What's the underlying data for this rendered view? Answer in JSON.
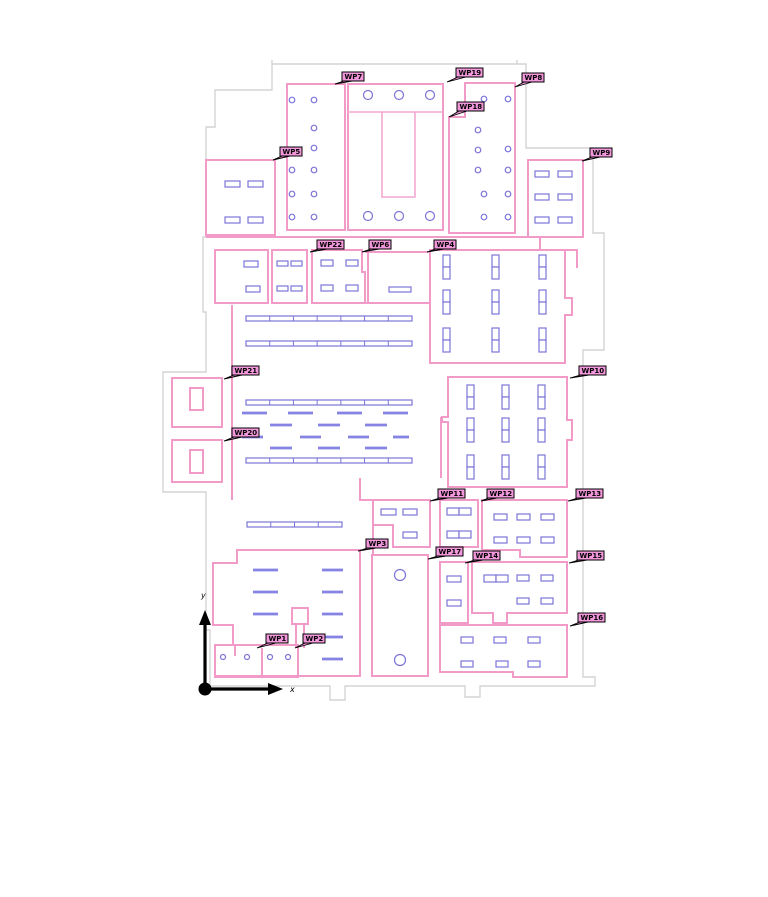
{
  "colors": {
    "background": "#ffffff",
    "wall": "#F29BC9",
    "wall_inner": "#F4A8D1",
    "outline": "#D4D4D4",
    "furniture": "#7B74D8",
    "furniture_fill": "#FFFFFF",
    "dash": "#8583E3",
    "label_fill": "#F297DC",
    "label_border": "#000000",
    "label_text": "#000000",
    "axis": "#000000"
  },
  "axis": {
    "x_label": "x",
    "y_label": "y",
    "origin": [
      205,
      689
    ],
    "x_tip": [
      283,
      689
    ],
    "y_tip": [
      205,
      610
    ],
    "x_label_pos": [
      290,
      692
    ],
    "y_label_pos": [
      201,
      598
    ]
  },
  "waypoints": [
    {
      "id": "WP1",
      "box": [
        266,
        634,
        22,
        9
      ],
      "anchor": [
        257,
        648
      ]
    },
    {
      "id": "WP2",
      "box": [
        303,
        634,
        22,
        9
      ],
      "anchor": [
        295,
        648
      ]
    },
    {
      "id": "WP3",
      "box": [
        366,
        539,
        22,
        9
      ],
      "anchor": [
        358,
        551
      ]
    },
    {
      "id": "WP4",
      "box": [
        434,
        240,
        22,
        9
      ],
      "anchor": [
        427,
        252
      ]
    },
    {
      "id": "WP5",
      "box": [
        280,
        147,
        22,
        9
      ],
      "anchor": [
        273,
        160
      ]
    },
    {
      "id": "WP6",
      "box": [
        369,
        240,
        22,
        9
      ],
      "anchor": [
        362,
        252
      ]
    },
    {
      "id": "WP7",
      "box": [
        342,
        72,
        22,
        9
      ],
      "anchor": [
        335,
        84
      ]
    },
    {
      "id": "WP8",
      "box": [
        522,
        73,
        22,
        9
      ],
      "anchor": [
        515,
        87
      ]
    },
    {
      "id": "WP9",
      "box": [
        590,
        148,
        22,
        9
      ],
      "anchor": [
        582,
        161
      ]
    },
    {
      "id": "WP10",
      "box": [
        579,
        366,
        27,
        9
      ],
      "anchor": [
        570,
        378
      ]
    },
    {
      "id": "WP11",
      "box": [
        438,
        489,
        27,
        9
      ],
      "anchor": [
        430,
        501
      ]
    },
    {
      "id": "WP12",
      "box": [
        487,
        489,
        27,
        9
      ],
      "anchor": [
        481,
        501
      ]
    },
    {
      "id": "WP13",
      "box": [
        576,
        489,
        27,
        9
      ],
      "anchor": [
        568,
        501
      ]
    },
    {
      "id": "WP14",
      "box": [
        473,
        551,
        27,
        9
      ],
      "anchor": [
        465,
        563
      ]
    },
    {
      "id": "WP15",
      "box": [
        577,
        551,
        27,
        9
      ],
      "anchor": [
        569,
        563
      ]
    },
    {
      "id": "WP16",
      "box": [
        578,
        613,
        27,
        9
      ],
      "anchor": [
        570,
        626
      ]
    },
    {
      "id": "WP17",
      "box": [
        436,
        547,
        27,
        9
      ],
      "anchor": [
        428,
        559
      ]
    },
    {
      "id": "WP18",
      "box": [
        457,
        102,
        27,
        9
      ],
      "anchor": [
        449,
        117
      ]
    },
    {
      "id": "WP19",
      "box": [
        456,
        68,
        27,
        9
      ],
      "anchor": [
        447,
        82
      ]
    },
    {
      "id": "WP20",
      "box": [
        232,
        428,
        27,
        9
      ],
      "anchor": [
        224,
        441
      ]
    },
    {
      "id": "WP21",
      "box": [
        232,
        366,
        27,
        9
      ],
      "anchor": [
        224,
        379
      ]
    },
    {
      "id": "WP22",
      "box": [
        317,
        240,
        27,
        9
      ],
      "anchor": [
        310,
        252
      ]
    }
  ],
  "floorplan": {
    "outline_path": "M272,60 V64 H517 V60 M517,64 H526 V148 H593 V233 H604 V350 H583 V677 H595 V686 H480 V697 H465 V686 H345 V700 H330 V686 H210 V630 H206 V492 H163 V372 H206 V312 H203 V237 H206 V127 H215 V90 H272 V64",
    "walls": [
      "M206,160 H275 V235 H206 Z",
      "M287,84 H345 V230 H287 Z",
      "M348,84 H443 V230 H348 Z",
      "M465,83 H515 V233 H449 V117 H465 Z",
      "M528,160 H583 V237 H528 Z",
      "M540,237 V250 H577 V268",
      "M206,237 H528",
      "M215,250 H268 V303 H215 Z",
      "M272,250 H307 V303 H272 Z",
      "M312,250 H362 V272 H365 V303 H312 Z",
      "M365,252 H428 M368,252 V303 M365,303 H430",
      "M430,250 H565 V298 H572 V315 H565 V363 H430 Z",
      "M448,377 H567 V420 H572 V440 H567 V487 H448 V422 H442 V417 H448 Z",
      "M172,378 H222 V427 H172 Z",
      "M190,388 h13 v22 h-13 Z",
      "M172,440 H222 V482 H172 Z",
      "M190,450 h13 v23 h-13 Z",
      "M232,305 V500",
      "M360,478 V500 H373 V555",
      "M441,417 V478",
      "M237,550 H360 V676 H215 V645 H233 V625 H213 V563 H237 Z",
      "M215,645 H298 V677 H215 Z",
      "M235,645 V656",
      "M262,648 V677",
      "M292,608 h16 v16 h-16 Z",
      "M296,624 V648 M304,624 V648",
      "M372,555 H428 V676 H372 Z",
      "M373,500 H430 V547 H393 V525 H373 Z",
      "M440,500 H478 V547 H440 Z",
      "M482,500 H567 V557 H520 V550 H482 Z",
      "M440,562 H468 V623 H440 Z",
      "M472,562 H567 V613 H507 V623 H493 V613 H472 Z",
      "M440,625 H567 V677 H513 V672 H440 Z"
    ],
    "inner_walls": [
      "M348,112 H443",
      "M382,112 V197 H415 V112"
    ],
    "desks": [
      [
        225,
        181,
        15,
        6
      ],
      [
        248,
        181,
        15,
        6
      ],
      [
        225,
        217,
        15,
        6
      ],
      [
        248,
        217,
        15,
        6
      ],
      [
        535,
        171,
        14,
        6
      ],
      [
        558,
        171,
        14,
        6
      ],
      [
        535,
        194,
        14,
        6
      ],
      [
        558,
        194,
        14,
        6
      ],
      [
        535,
        217,
        14,
        6
      ],
      [
        558,
        217,
        14,
        6
      ],
      [
        244,
        261,
        14,
        6
      ],
      [
        246,
        286,
        14,
        6
      ],
      [
        277,
        261,
        11,
        5
      ],
      [
        291,
        261,
        11,
        5
      ],
      [
        277,
        286,
        11,
        5
      ],
      [
        291,
        286,
        11,
        5
      ],
      [
        321,
        260,
        12,
        6
      ],
      [
        346,
        260,
        12,
        6
      ],
      [
        321,
        285,
        12,
        6
      ],
      [
        346,
        285,
        12,
        6
      ],
      [
        389,
        287,
        22,
        5
      ],
      [
        381,
        509,
        15,
        6
      ],
      [
        403,
        509,
        14,
        6
      ],
      [
        403,
        532,
        14,
        6
      ],
      [
        447,
        508,
        12,
        7
      ],
      [
        459,
        508,
        12,
        7
      ],
      [
        447,
        531,
        12,
        7
      ],
      [
        459,
        531,
        12,
        7
      ],
      [
        494,
        514,
        13,
        6
      ],
      [
        517,
        514,
        13,
        6
      ],
      [
        541,
        514,
        13,
        6
      ],
      [
        494,
        537,
        13,
        6
      ],
      [
        517,
        537,
        13,
        6
      ],
      [
        541,
        537,
        13,
        6
      ],
      [
        447,
        576,
        14,
        6
      ],
      [
        447,
        600,
        14,
        6
      ],
      [
        484,
        575,
        12,
        7
      ],
      [
        496,
        575,
        12,
        7
      ],
      [
        517,
        575,
        12,
        6
      ],
      [
        541,
        575,
        12,
        6
      ],
      [
        517,
        598,
        12,
        6
      ],
      [
        541,
        598,
        12,
        6
      ],
      [
        461,
        637,
        12,
        6
      ],
      [
        494,
        637,
        12,
        6
      ],
      [
        528,
        637,
        12,
        6
      ],
      [
        461,
        661,
        12,
        6
      ],
      [
        496,
        661,
        12,
        6
      ],
      [
        528,
        661,
        12,
        6
      ]
    ],
    "vdesks": [
      [
        443,
        255
      ],
      [
        492,
        255
      ],
      [
        539,
        255
      ],
      [
        443,
        290
      ],
      [
        492,
        290
      ],
      [
        539,
        290
      ],
      [
        443,
        328
      ],
      [
        492,
        328
      ],
      [
        539,
        328
      ],
      [
        467,
        385
      ],
      [
        502,
        385
      ],
      [
        538,
        385
      ],
      [
        467,
        418
      ],
      [
        502,
        418
      ],
      [
        538,
        418
      ],
      [
        467,
        455
      ],
      [
        502,
        455
      ],
      [
        538,
        455
      ]
    ],
    "shelves": [
      {
        "x": 246,
        "y": 316,
        "w": 166,
        "h": 5,
        "seg": 7
      },
      {
        "x": 246,
        "y": 341,
        "w": 166,
        "h": 5,
        "seg": 7
      },
      {
        "x": 246,
        "y": 400,
        "w": 166,
        "h": 5,
        "seg": 7
      },
      {
        "x": 246,
        "y": 458,
        "w": 166,
        "h": 5,
        "seg": 7
      },
      {
        "x": 247,
        "y": 522,
        "w": 95,
        "h": 5,
        "seg": 4
      }
    ],
    "dashes": [
      [
        242,
        413,
        25
      ],
      [
        288,
        413,
        25
      ],
      [
        337,
        413,
        25
      ],
      [
        383,
        413,
        25
      ],
      [
        270,
        425,
        22
      ],
      [
        318,
        425,
        22
      ],
      [
        365,
        425,
        22
      ],
      [
        242,
        437,
        21
      ],
      [
        300,
        437,
        21
      ],
      [
        348,
        437,
        21
      ],
      [
        393,
        437,
        16
      ],
      [
        270,
        448,
        22
      ],
      [
        318,
        448,
        22
      ],
      [
        365,
        448,
        22
      ],
      [
        253,
        570,
        25
      ],
      [
        322,
        570,
        21
      ],
      [
        253,
        592,
        25
      ],
      [
        322,
        592,
        21
      ],
      [
        253,
        614,
        25
      ],
      [
        322,
        614,
        21
      ],
      [
        322,
        637,
        21
      ],
      [
        322,
        659,
        21
      ]
    ],
    "circles": [
      [
        292,
        100,
        2.8
      ],
      [
        314,
        100,
        2.8
      ],
      [
        314,
        128,
        2.8
      ],
      [
        314,
        148,
        2.8
      ],
      [
        292,
        170,
        2.8
      ],
      [
        314,
        170,
        2.8
      ],
      [
        292,
        194,
        2.8
      ],
      [
        314,
        194,
        2.8
      ],
      [
        292,
        217,
        2.8
      ],
      [
        314,
        217,
        2.8
      ],
      [
        484,
        99,
        2.8
      ],
      [
        508,
        99,
        2.8
      ],
      [
        478,
        130,
        2.8
      ],
      [
        478,
        150,
        2.8
      ],
      [
        508,
        149,
        2.8
      ],
      [
        478,
        170,
        2.8
      ],
      [
        508,
        170,
        2.8
      ],
      [
        484,
        194,
        2.8
      ],
      [
        508,
        194,
        2.8
      ],
      [
        484,
        217,
        2.8
      ],
      [
        508,
        217,
        2.8
      ],
      [
        223,
        657,
        2.5
      ],
      [
        247,
        657,
        2.5
      ],
      [
        270,
        657,
        2.5
      ],
      [
        288,
        657,
        2.5
      ],
      [
        368,
        95,
        4.5
      ],
      [
        399,
        95,
        4.5
      ],
      [
        430,
        95,
        4.5
      ],
      [
        368,
        216,
        4.5
      ],
      [
        399,
        216,
        4.5
      ],
      [
        430,
        216,
        4.5
      ],
      [
        400,
        575,
        5.5
      ],
      [
        400,
        660,
        5.5
      ]
    ]
  }
}
